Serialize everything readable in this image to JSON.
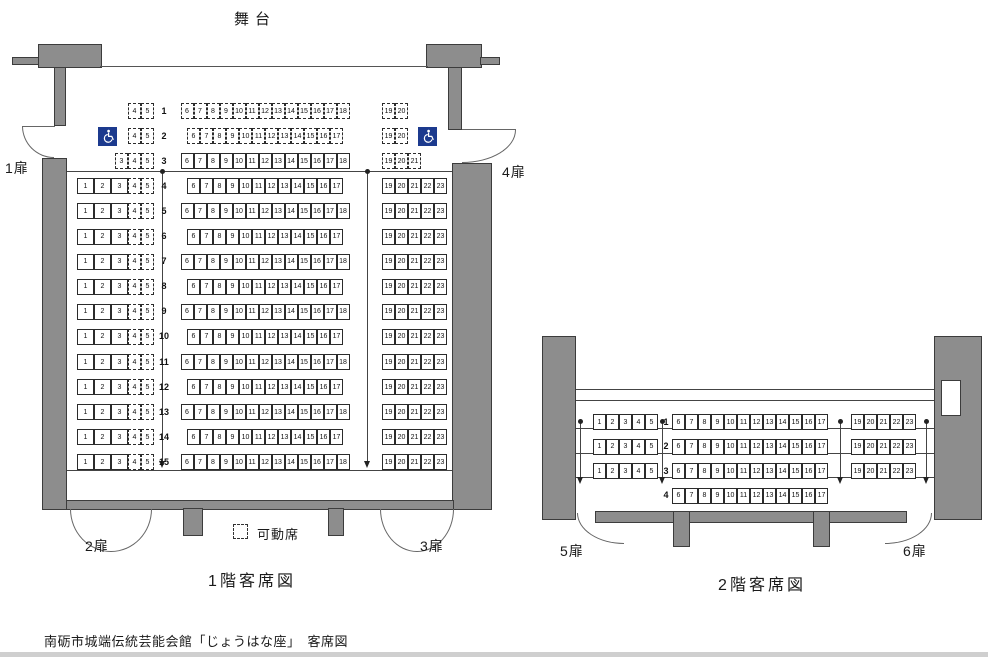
{
  "stage": {
    "label": "舞台"
  },
  "caption": "南砺市城端伝統芸能会館「じょうはな座」　客席図",
  "legend": {
    "movable": "可動席"
  },
  "colors": {
    "wall_gray": "#8d8d8d",
    "wall_border": "#3c3c3c",
    "line": "#444444",
    "seat_border": "#2b2b2b",
    "wheelchair_blue": "#1c3a8e"
  },
  "floor1": {
    "title": "1階客席図",
    "doors": {
      "d1": "1扉",
      "d2": "2扉",
      "d3": "3扉",
      "d4": "4扉"
    },
    "rows": [
      {
        "num": "1",
        "left_dashed": [
          "4",
          "5"
        ],
        "center": [
          "6",
          "7",
          "8",
          "9",
          "10",
          "11",
          "12",
          "13",
          "14",
          "15",
          "16",
          "17",
          "18"
        ],
        "center_dashed": true,
        "right": [
          "19",
          "20"
        ],
        "right_dashed": true
      },
      {
        "num": "2",
        "wheelchair": true,
        "left_dashed": [
          "4",
          "5"
        ],
        "center": [
          "6",
          "7",
          "8",
          "9",
          "10",
          "11",
          "12",
          "13",
          "14",
          "15",
          "16",
          "17"
        ],
        "center_dashed": true,
        "right": [
          "19",
          "20"
        ],
        "right_dashed": true
      },
      {
        "num": "3",
        "left_dashed": [
          "3",
          "4",
          "5"
        ],
        "center": [
          "6",
          "7",
          "8",
          "9",
          "10",
          "11",
          "12",
          "13",
          "14",
          "15",
          "16",
          "17",
          "18"
        ],
        "center_dashed": false,
        "right": [
          "19",
          "20",
          "21"
        ],
        "right_dashed": true
      },
      {
        "num": "4",
        "left_solid": [
          "1",
          "2",
          "3"
        ],
        "left_dashed": [
          "4",
          "5"
        ],
        "center": [
          "6",
          "7",
          "8",
          "9",
          "10",
          "11",
          "12",
          "13",
          "14",
          "15",
          "16",
          "17"
        ],
        "right": [
          "19",
          "20",
          "21",
          "22",
          "23"
        ]
      },
      {
        "num": "5",
        "left_solid": [
          "1",
          "2",
          "3"
        ],
        "left_dashed": [
          "4",
          "5"
        ],
        "center": [
          "6",
          "7",
          "8",
          "9",
          "10",
          "11",
          "12",
          "13",
          "14",
          "15",
          "16",
          "17",
          "18"
        ],
        "right": [
          "19",
          "20",
          "21",
          "22",
          "23"
        ]
      },
      {
        "num": "6",
        "left_solid": [
          "1",
          "2",
          "3"
        ],
        "left_dashed": [
          "4",
          "5"
        ],
        "center": [
          "6",
          "7",
          "8",
          "9",
          "10",
          "11",
          "12",
          "13",
          "14",
          "15",
          "16",
          "17"
        ],
        "right": [
          "19",
          "20",
          "21",
          "22",
          "23"
        ]
      },
      {
        "num": "7",
        "left_solid": [
          "1",
          "2",
          "3"
        ],
        "left_dashed": [
          "4",
          "5"
        ],
        "center": [
          "6",
          "7",
          "8",
          "9",
          "10",
          "11",
          "12",
          "13",
          "14",
          "15",
          "16",
          "17",
          "18"
        ],
        "right": [
          "19",
          "20",
          "21",
          "22",
          "23"
        ]
      },
      {
        "num": "8",
        "left_solid": [
          "1",
          "2",
          "3"
        ],
        "left_dashed": [
          "4",
          "5"
        ],
        "center": [
          "6",
          "7",
          "8",
          "9",
          "10",
          "11",
          "12",
          "13",
          "14",
          "15",
          "16",
          "17"
        ],
        "right": [
          "19",
          "20",
          "21",
          "22",
          "23"
        ]
      },
      {
        "num": "9",
        "left_solid": [
          "1",
          "2",
          "3"
        ],
        "left_dashed": [
          "4",
          "5"
        ],
        "center": [
          "6",
          "7",
          "8",
          "9",
          "10",
          "11",
          "12",
          "13",
          "14",
          "15",
          "16",
          "17",
          "18"
        ],
        "right": [
          "19",
          "20",
          "21",
          "22",
          "23"
        ]
      },
      {
        "num": "10",
        "left_solid": [
          "1",
          "2",
          "3"
        ],
        "left_dashed": [
          "4",
          "5"
        ],
        "center": [
          "6",
          "7",
          "8",
          "9",
          "10",
          "11",
          "12",
          "13",
          "14",
          "15",
          "16",
          "17"
        ],
        "right": [
          "19",
          "20",
          "21",
          "22",
          "23"
        ]
      },
      {
        "num": "11",
        "left_solid": [
          "1",
          "2",
          "3"
        ],
        "left_dashed": [
          "4",
          "5"
        ],
        "center": [
          "6",
          "7",
          "8",
          "9",
          "10",
          "11",
          "12",
          "13",
          "14",
          "15",
          "16",
          "17",
          "18"
        ],
        "right": [
          "19",
          "20",
          "21",
          "22",
          "23"
        ]
      },
      {
        "num": "12",
        "left_solid": [
          "1",
          "2",
          "3"
        ],
        "left_dashed": [
          "4",
          "5"
        ],
        "center": [
          "6",
          "7",
          "8",
          "9",
          "10",
          "11",
          "12",
          "13",
          "14",
          "15",
          "16",
          "17"
        ],
        "right": [
          "19",
          "20",
          "21",
          "22",
          "23"
        ]
      },
      {
        "num": "13",
        "left_solid": [
          "1",
          "2",
          "3"
        ],
        "left_dashed": [
          "4",
          "5"
        ],
        "center": [
          "6",
          "7",
          "8",
          "9",
          "10",
          "11",
          "12",
          "13",
          "14",
          "15",
          "16",
          "17",
          "18"
        ],
        "right": [
          "19",
          "20",
          "21",
          "22",
          "23"
        ]
      },
      {
        "num": "14",
        "left_solid": [
          "1",
          "2",
          "3"
        ],
        "left_dashed": [
          "4",
          "5"
        ],
        "center": [
          "6",
          "7",
          "8",
          "9",
          "10",
          "11",
          "12",
          "13",
          "14",
          "15",
          "16",
          "17"
        ],
        "right": [
          "19",
          "20",
          "21",
          "22",
          "23"
        ]
      },
      {
        "num": "15",
        "left_solid": [
          "1",
          "2",
          "3"
        ],
        "left_dashed": [
          "4",
          "5"
        ],
        "center": [
          "6",
          "7",
          "8",
          "9",
          "10",
          "11",
          "12",
          "13",
          "14",
          "15",
          "16",
          "17",
          "18"
        ],
        "right": [
          "19",
          "20",
          "21",
          "22",
          "23"
        ]
      }
    ]
  },
  "floor2": {
    "title": "2階客席図",
    "doors": {
      "d5": "5扉",
      "d6": "6扉"
    },
    "rows": [
      {
        "num": "1",
        "left": [
          "1",
          "2",
          "3",
          "4",
          "5"
        ],
        "center": [
          "6",
          "7",
          "8",
          "9",
          "10",
          "11",
          "12",
          "13",
          "14",
          "15",
          "16",
          "17"
        ],
        "right": [
          "19",
          "20",
          "21",
          "22",
          "23"
        ]
      },
      {
        "num": "2",
        "left": [
          "1",
          "2",
          "3",
          "4",
          "5"
        ],
        "center": [
          "6",
          "7",
          "8",
          "9",
          "10",
          "11",
          "12",
          "13",
          "14",
          "15",
          "16",
          "17"
        ],
        "right": [
          "19",
          "20",
          "21",
          "22",
          "23"
        ]
      },
      {
        "num": "3",
        "left": [
          "1",
          "2",
          "3",
          "4",
          "5"
        ],
        "center": [
          "6",
          "7",
          "8",
          "9",
          "10",
          "11",
          "12",
          "13",
          "14",
          "15",
          "16",
          "17"
        ],
        "right": [
          "19",
          "20",
          "21",
          "22",
          "23"
        ]
      },
      {
        "num": "4",
        "center": [
          "6",
          "7",
          "8",
          "9",
          "10",
          "11",
          "12",
          "13",
          "14",
          "15",
          "16",
          "17"
        ]
      }
    ]
  }
}
